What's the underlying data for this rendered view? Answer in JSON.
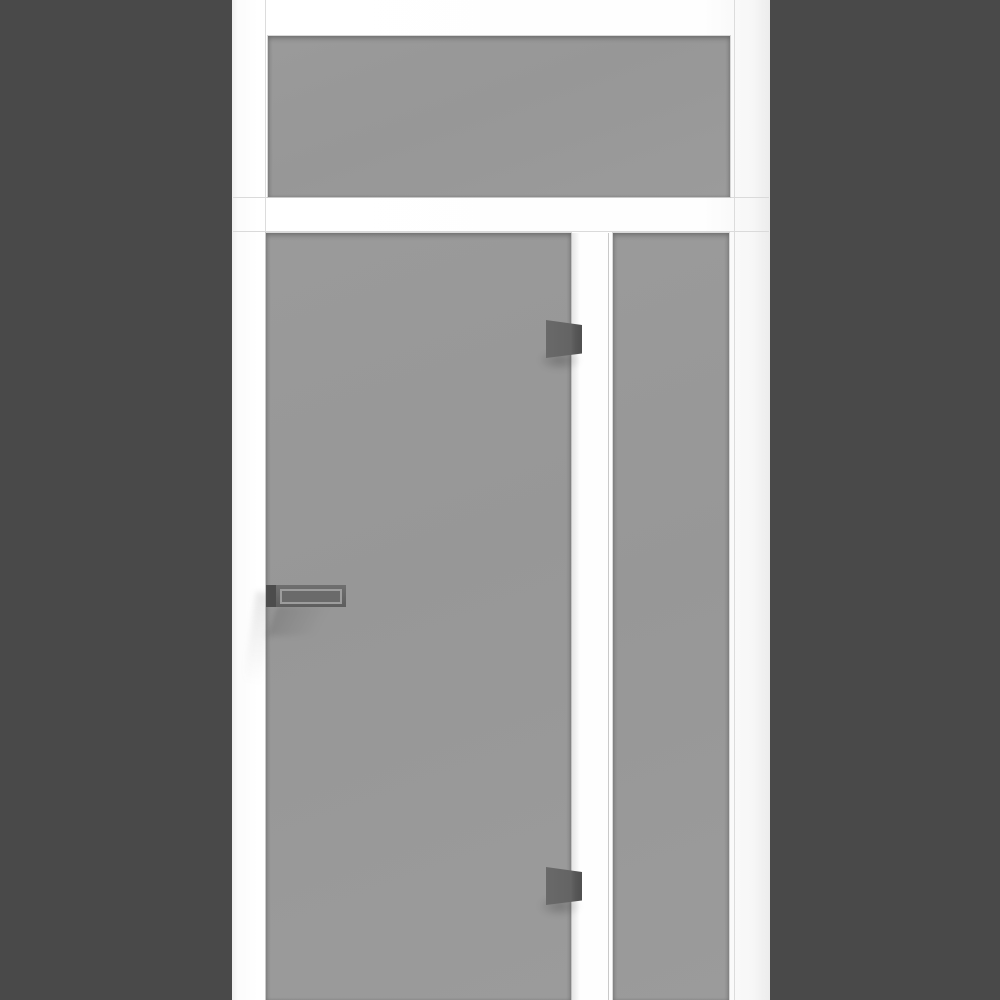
{
  "scene": {
    "type": "3d-product-render",
    "subject": "white-framed door unit with transom window, frosted glass door and sidelight"
  },
  "colors": {
    "bg-outer": "#494949",
    "frame-white": "#fdfdfd",
    "frame-line": "#d6d6d6",
    "glass": "#999999",
    "glass-dark-edge": "#8e8e8e",
    "hinge": "#646464",
    "hinge-edge": "#4f4f4f",
    "handle": "#656565",
    "handle-mount": "#4c4c4c",
    "handle-inset-outline": "#9d9d9d"
  },
  "parts": {
    "transom": "transom-window-glass",
    "door": "door-glass-panel",
    "sidelight": "sidelight-glass-panel",
    "mullion": "frame-mullion",
    "handle": "door-pull-handle",
    "hinge_top": "top-hinge",
    "hinge_bottom": "bottom-hinge"
  }
}
